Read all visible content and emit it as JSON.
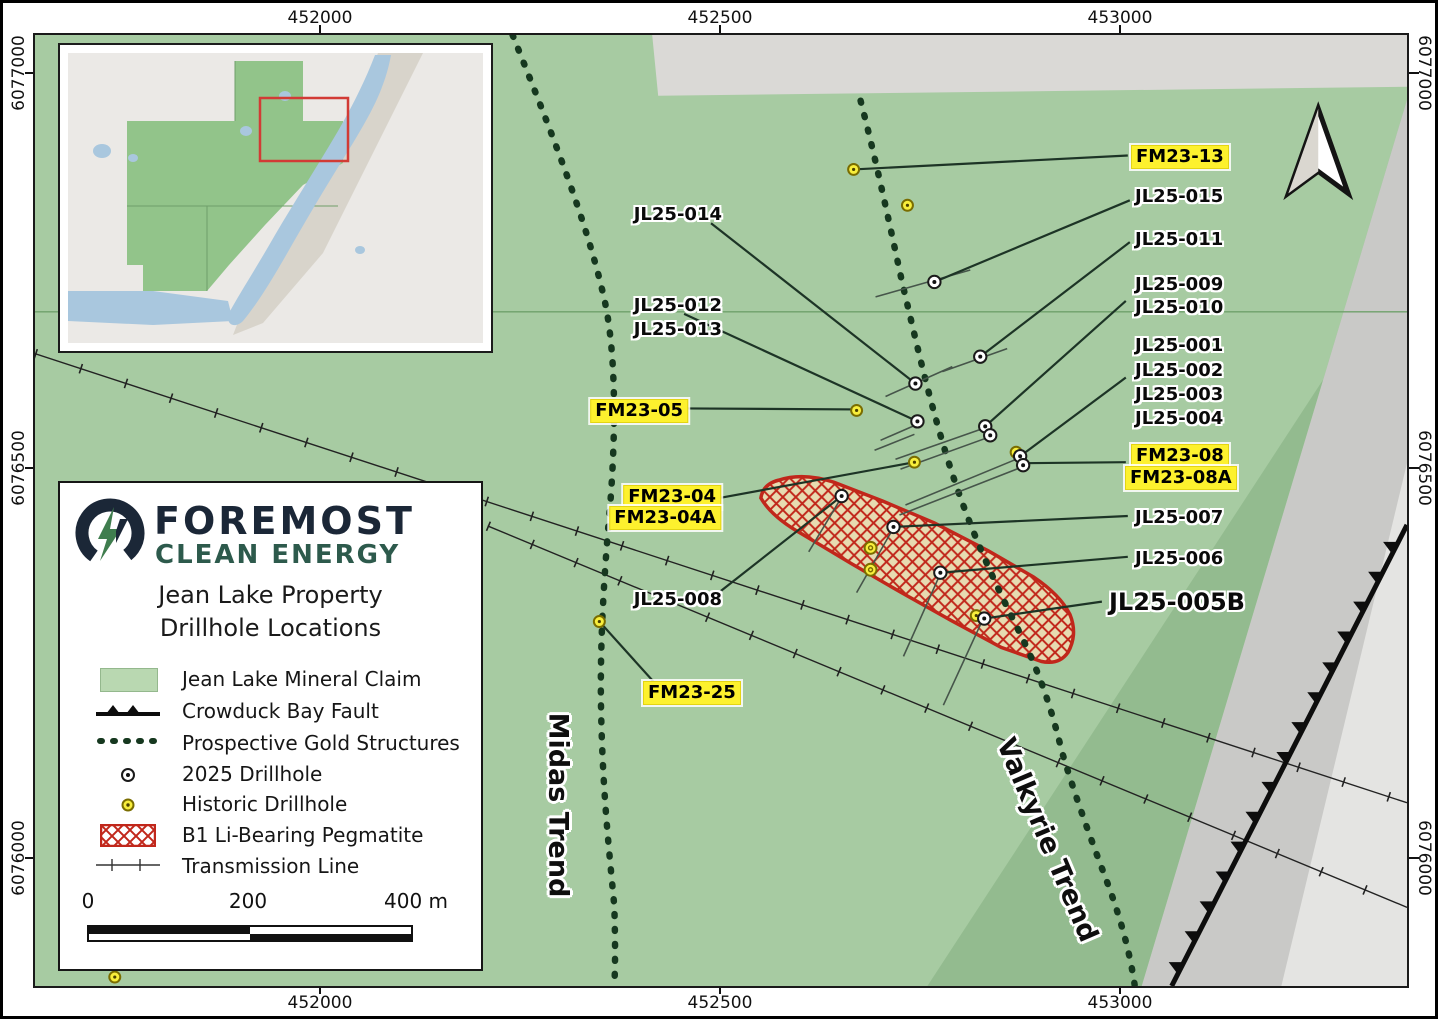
{
  "map_title": {
    "line1": "Jean Lake Property",
    "line2": "Drillhole Locations"
  },
  "logo": {
    "name_top": "FOREMOST",
    "name_bottom": "CLEAN ENERGY"
  },
  "legend": {
    "items": [
      {
        "label": "Jean Lake Mineral Claim",
        "icon": "claim-swatch"
      },
      {
        "label": "Crowduck Bay Fault",
        "icon": "fault-line"
      },
      {
        "label": "Prospective Gold Structures",
        "icon": "dotted-line"
      },
      {
        "label": "2025 Drillhole",
        "icon": "drillhole-2025"
      },
      {
        "label": "Historic Drillhole",
        "icon": "drillhole-historic"
      },
      {
        "label": "B1 Li-Bearing Pegmatite",
        "icon": "pegmatite-swatch"
      },
      {
        "label": "Transmission Line",
        "icon": "transmission-line"
      }
    ],
    "scale_bar": {
      "start": "0",
      "middle": "200",
      "end": "400 m"
    }
  },
  "axes": {
    "top": [
      "452000",
      "452500",
      "453000"
    ],
    "bottom": [
      "452000",
      "452500",
      "453000"
    ],
    "left": [
      "6077000",
      "6076500",
      "6076000"
    ],
    "right": [
      "6077000",
      "6076500",
      "6076000"
    ]
  },
  "trend_labels": {
    "midas": "Midas Trend",
    "valkyrie": "Valkyrie Trend"
  },
  "drillholes": {
    "fm23_13": "FM23-13",
    "jl25_015": "JL25-015",
    "jl25_011": "JL25-011",
    "jl25_009": "JL25-009",
    "jl25_010": "JL25-010",
    "jl25_001": "JL25-001",
    "jl25_002": "JL25-002",
    "jl25_003": "JL25-003",
    "jl25_004": "JL25-004",
    "fm23_08": "FM23-08",
    "fm23_08a": "FM23-08A",
    "jl25_007": "JL25-007",
    "jl25_006": "JL25-006",
    "jl25_005b": "JL25-005B",
    "jl25_014": "JL25-014",
    "jl25_012": "JL25-012",
    "jl25_013": "JL25-013",
    "fm23_05": "FM23-05",
    "fm23_04": "FM23-04",
    "fm23_04a": "FM23-04A",
    "jl25_008": "JL25-008",
    "fm23_25": "FM23-25"
  },
  "colors": {
    "claim_green": "#a7cba2",
    "dark_green_band": "#93bb8f",
    "terrain_gray": "#c9c9c7",
    "terrain_light_gray": "#e4e4e2",
    "pegmatite_red": "#c1271b",
    "highlight_yellow": "#fdf12e",
    "historic_yellow": "#f8ee3c",
    "trend_green": "#16381f"
  }
}
